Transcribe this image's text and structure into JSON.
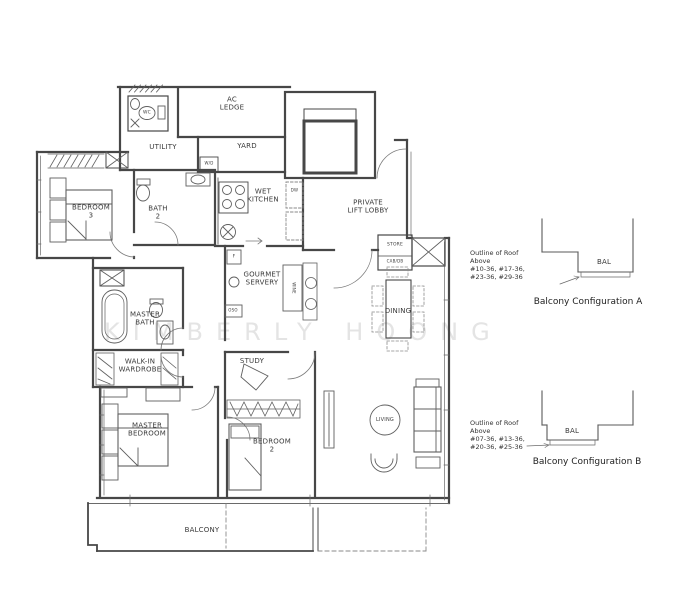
{
  "watermark": "KIMBERLY HOONG",
  "plan": {
    "rooms": {
      "ac_ledge": "AC\nLEDGE",
      "wc": "WC",
      "utility": "UTILITY",
      "yard": "YARD",
      "wet_kitchen": "WET\nKITCHEN",
      "private_lift_lobby": "PRIVATE\nLIFT LOBBY",
      "bedroom_3": "BEDROOM\n3",
      "bath_2": "BATH\n2",
      "store": "STORE",
      "cab_db": "CAB/DB",
      "gourmet_servery": "GOURMET\nSERVERY",
      "master_bath": "MASTER\nBATH",
      "walk_in_wardrobe": "WALK-IN\nWARDROBE",
      "dining": "DINING",
      "study": "STUDY",
      "master_bedroom": "MASTER\nBEDROOM",
      "bedroom_2": "BEDROOM\n2",
      "living": "LIVING",
      "balcony": "BALCONY"
    },
    "appliances": {
      "wd": "W/D",
      "dw": "DW",
      "fridge": "F",
      "wine": "WINE",
      "oso": "OSO"
    }
  },
  "annotations": {
    "config_a": {
      "note_lines": [
        "Outline of Roof",
        "Above",
        "#10-36, #17-36,",
        "#23-36, #29-36"
      ],
      "bal_label": "BAL",
      "caption": "Balcony Configuration A"
    },
    "config_b": {
      "note_lines": [
        "Outline of Roof",
        "Above",
        "#07-36, #13-36,",
        "#20-36, #25-36"
      ],
      "bal_label": "BAL",
      "caption": "Balcony Configuration B"
    }
  },
  "colors": {
    "wall": "#474747",
    "furniture": "#5f5f5f",
    "dashed": "#8a8a8a",
    "text": "#3a3a3a",
    "watermark": "#e4e4e4",
    "background": "#ffffff"
  }
}
